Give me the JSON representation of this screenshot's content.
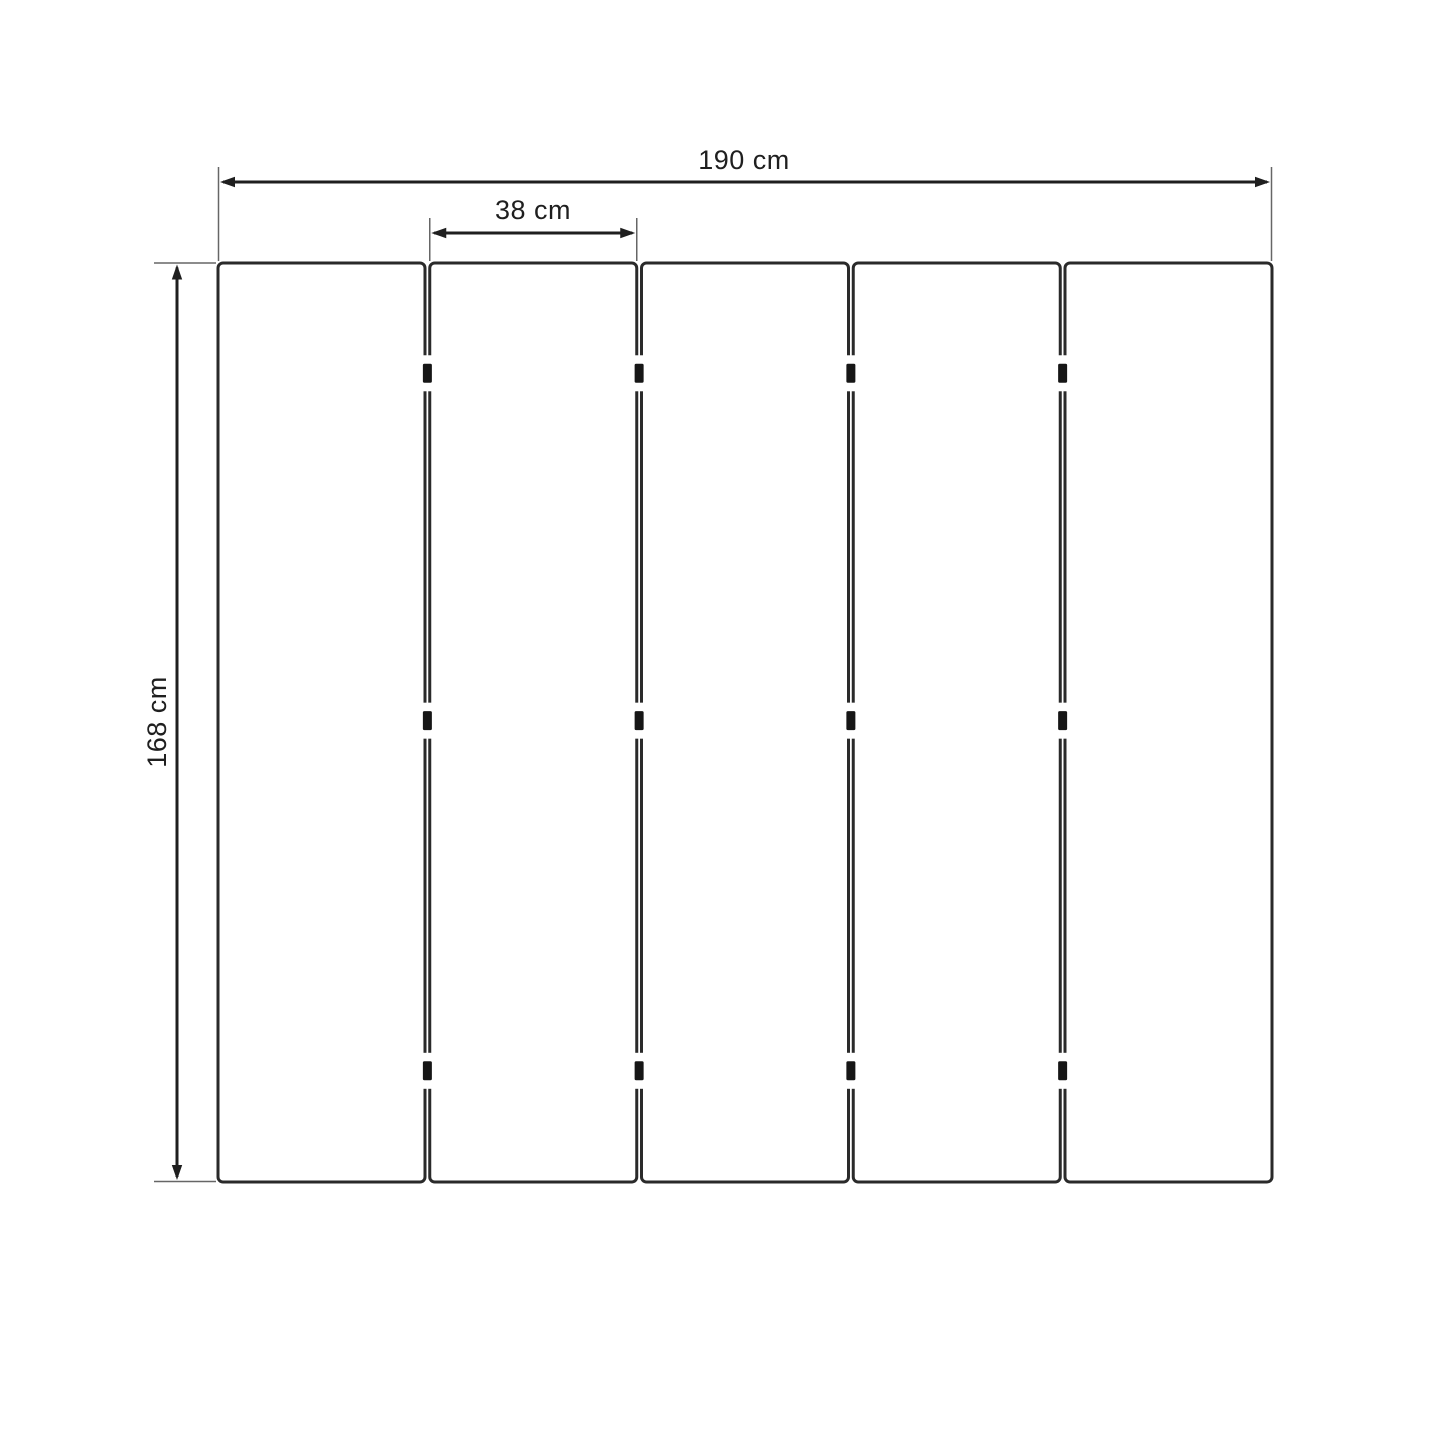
{
  "diagram": {
    "type": "dimension-drawing",
    "subject": "five vertical panels joined by hinges (folding screen front view)",
    "labels": {
      "total_width": "190 cm",
      "panel_width": "38 cm",
      "height": "168 cm"
    },
    "values_cm": {
      "total_width": 190,
      "panel_width": 38,
      "height": 168
    },
    "panels": {
      "count": 5,
      "hinge_columns": 4,
      "hinges_per_column": 3
    },
    "colors": {
      "background": "#ffffff",
      "panel_fill": "#ffffff",
      "panel_stroke": "#2a2a2a",
      "dimension_line": "#1f1f1f",
      "extension_line": "#666666",
      "hinge": "#161616",
      "label_text": "#1f1f1f"
    }
  }
}
